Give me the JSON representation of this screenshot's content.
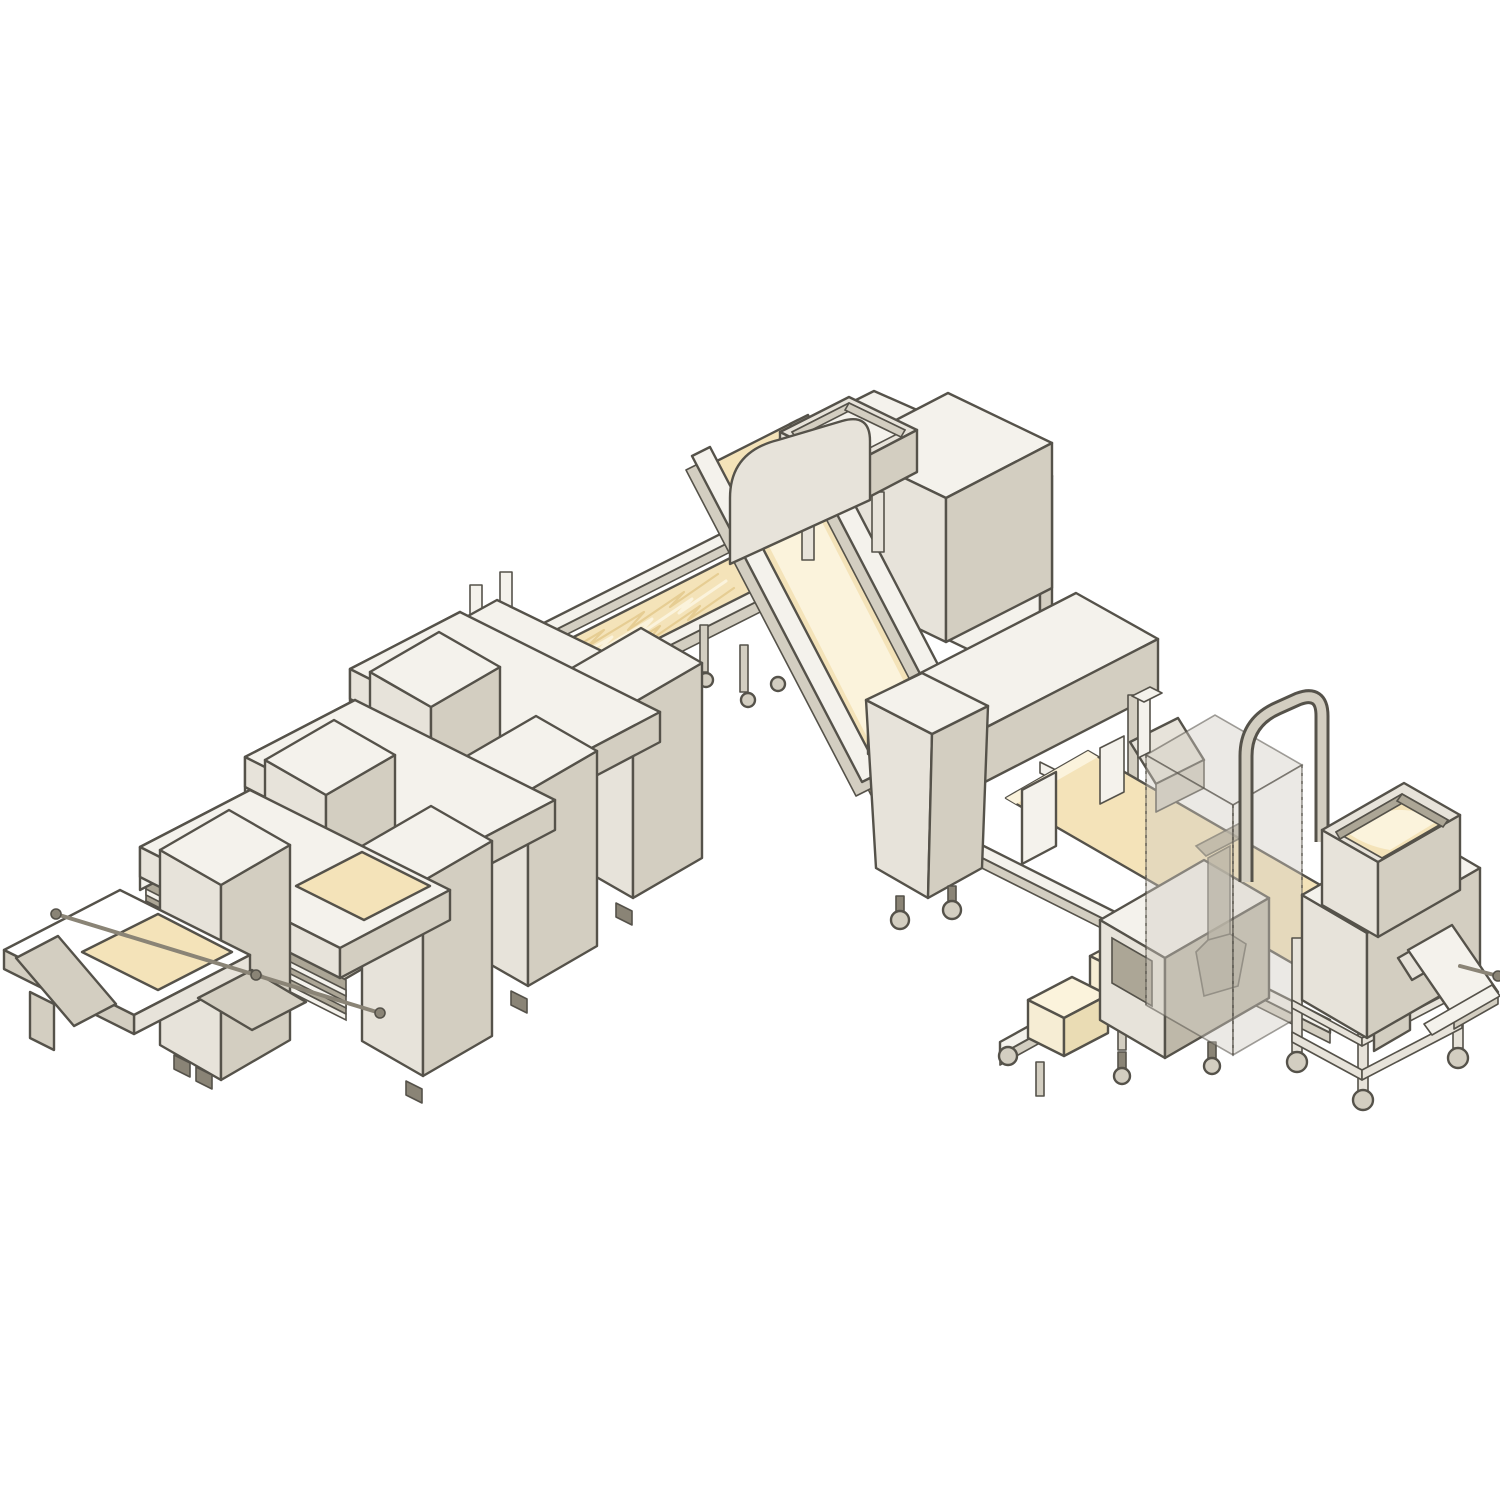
{
  "meta": {
    "title": "Industrial dough laminating production line - isometric illustration",
    "description": "Isometric cutaway-style illustration of a bakery dough sheeting and laminating line: dough feeder with hopper on a trolley, butter block feeder, safety guard, bridge sheeter, incline conveyor, folding lapper with flour hopper, block station and a row of three gauging sheeters ending at a cross take-off table.",
    "background": "#ffffff",
    "visible_text": []
  },
  "palette": {
    "bg": "#ffffff",
    "outline": "#55524a",
    "panelTop": "#f4f2ec",
    "panelLight": "#e7e3da",
    "panelMid": "#d3cec1",
    "panelDark": "#beb8a9",
    "panelShadow": "#aca696",
    "metal": "#8a8476",
    "dough": "#f4e3b9",
    "doughLight": "#fbf3dc",
    "doughDeep": "#e6cd93",
    "glass": "rgba(208,203,192,0.42)",
    "glassEdge": "rgba(85,82,74,0.55)"
  },
  "scene": {
    "left_sheeter_count": 3,
    "butter_block_count": 2,
    "dough_flow": "right to left",
    "projection": "isometric 2:1"
  },
  "components": {
    "line": {
      "label": "dough laminating production line"
    },
    "lapper": {
      "label": "folding lapper machine with flour hopper"
    },
    "hopper": {
      "label": "flour hopper"
    },
    "sidePanel": {
      "label": "white side guard panel"
    },
    "foldConveyor": {
      "label": "folding conveyor with lapped dough"
    },
    "cubeStation": {
      "label": "dough block station on casters"
    },
    "incline": {
      "label": "inclined dough sheet conveyor"
    },
    "bridgeSheeter": {
      "label": "bridge gauging sheeter"
    },
    "outfeed": {
      "label": "outfeed conveyor with dough sheet"
    },
    "butterConveyor": {
      "label": "butter block infeed conveyor"
    },
    "butterBlock": {
      "label": "butter block"
    },
    "butterFeeder": {
      "label": "butter feeder tunnel"
    },
    "safetyGuard": {
      "label": "transparent safety guard enclosure"
    },
    "guardArch": {
      "label": "tubular guard arch"
    },
    "doughFeeder": {
      "label": "dough feeder with hopper on mobile trolley"
    },
    "feederHopper": {
      "label": "dough hopper full of dough"
    },
    "discharge": {
      "label": "discharge chute and tray"
    },
    "sheeter1": {
      "label": "gauging sheeter 1"
    },
    "sheeter2": {
      "label": "gauging sheeter 2"
    },
    "sheeter3": {
      "label": "gauging sheeter 3"
    },
    "crossTable": {
      "label": "take-off cross table"
    },
    "spreaderRod": {
      "label": "spreader rod over dough sheet"
    },
    "doughSheet": {
      "label": "dough sheet"
    },
    "caster": {
      "label": "caster wheel"
    }
  }
}
